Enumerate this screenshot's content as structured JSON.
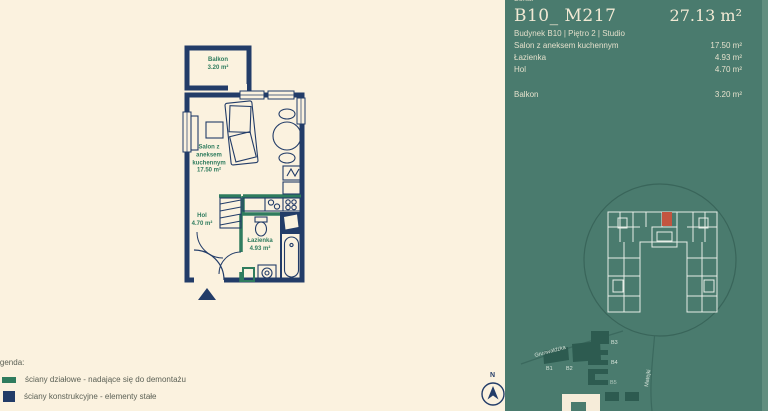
{
  "colors": {
    "background_cream": "#fbf2df",
    "wall_structural_navy": "#223c68",
    "wall_partition_green": "#2f7c5e",
    "panel_green": "#4a7b6e",
    "sitemap_building_dark": "#2d5a4f",
    "sitemap_outline_white": "#e7eee7",
    "unit_highlight_red": "#c35540",
    "panel_text_cream": "#f2e9d4"
  },
  "plan": {
    "rooms": {
      "balkon": {
        "label": "Balkon\n3.20 m²"
      },
      "salon": {
        "label": "Salon z\naneksem\nkuchennym\n17.50 m²"
      },
      "hol": {
        "label": "Hol\n4.70 m²"
      },
      "lazienka": {
        "label": "Łazienka\n4.93 m²"
      }
    },
    "compass_north": "N"
  },
  "legend": {
    "title": "Legenda:",
    "items": [
      {
        "label": "ściany działowe - nadające się do demontażu",
        "color": "#2f7c5e"
      },
      {
        "label": "ściany konstrukcyjne - elementy stałe",
        "color": "#223c68"
      }
    ]
  },
  "panel": {
    "top_label": "Lokal",
    "unit_id": "B10_ M217",
    "total_area": "27.13 m²",
    "subtitle": "Budynek B10 | Piętro 2 | Studio",
    "rooms": [
      {
        "name": "Salon z aneksem kuchennym",
        "area": "17.50 m²"
      },
      {
        "name": "Łazienka",
        "area": "4.93 m²"
      },
      {
        "name": "Hol",
        "area": "4.70 m²"
      }
    ],
    "balkon": {
      "name": "Balkon",
      "area": "3.20 m²"
    },
    "sitemap": {
      "street_1": "Grunwaldzka",
      "street_2": "Matejki",
      "buildings": [
        "B1",
        "B2",
        "B3",
        "B4",
        "B5"
      ]
    }
  }
}
